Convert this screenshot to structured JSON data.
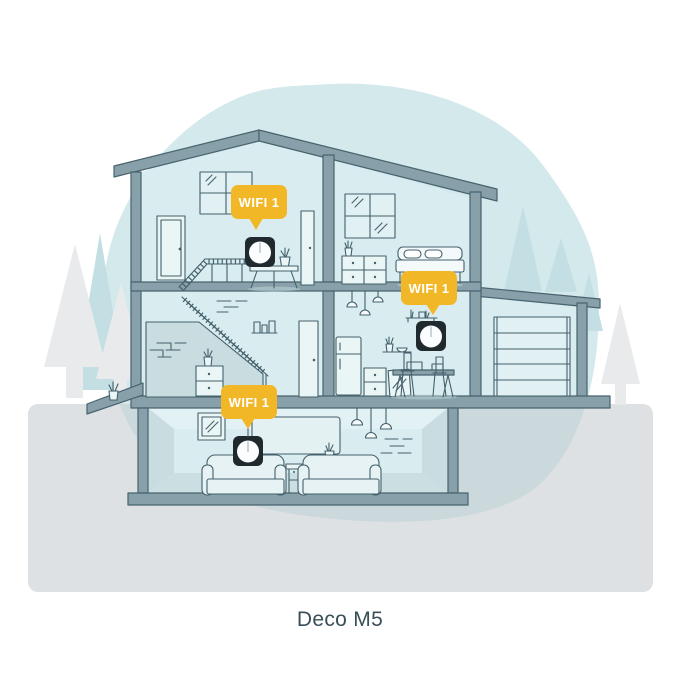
{
  "caption": "Deco M5",
  "badges": [
    {
      "id": "attic",
      "label": "WIFI 1"
    },
    {
      "id": "kitchen",
      "label": "WIFI 1"
    },
    {
      "id": "basement",
      "label": "WIFI 1"
    }
  ],
  "colors": {
    "badge": "#F2B727",
    "badge_text": "#FFFFFF",
    "device_body": "#20292E",
    "device_face": "#FCFDFE",
    "blob": "#D3E9EC",
    "ground_overlay": "rgb(197,204,208)",
    "structure": "#87A0A9",
    "outline": "#47636E",
    "room": "#D9EDF0",
    "tree_teal": "#C3DFE3",
    "tree_gray": "#E8EAEB",
    "caption_text": "#3B4F59"
  }
}
